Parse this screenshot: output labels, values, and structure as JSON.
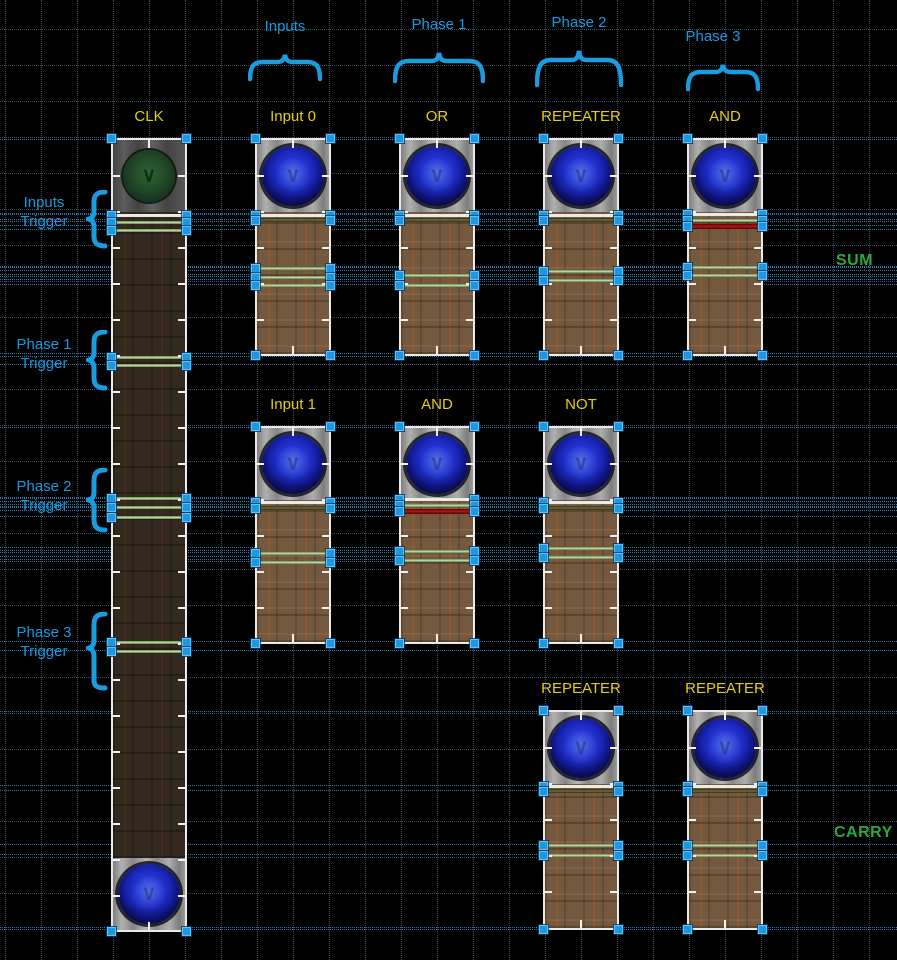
{
  "canvas": {
    "width": 897,
    "height": 960,
    "background": "#000000"
  },
  "grid": {
    "size": 36,
    "offset_x": 5,
    "offset_y": 29,
    "color": "#3b4d61",
    "guide_color": "#2e79ab"
  },
  "colors": {
    "annotation_blue": "#189ae2",
    "device_label_yellow": "#e5d005",
    "output_label_green": "#27a93f",
    "selection_handle_blue": "#1b98e0",
    "trigger_line_green": "#b2d395",
    "trigger_line_red": "#b41212",
    "trigger_line_white": "#eaeaea"
  },
  "top_groups": [
    {
      "label": "Inputs"
    },
    {
      "label": "Phase 1"
    },
    {
      "label": "Phase 2"
    },
    {
      "label": "Phase 3"
    }
  ],
  "left_triggers": [
    {
      "line1": "Inputs",
      "line2": "Trigger"
    },
    {
      "line1": "Phase 1",
      "line2": "Trigger"
    },
    {
      "line1": "Phase 2",
      "line2": "Trigger"
    },
    {
      "line1": "Phase 3",
      "line2": "Trigger"
    }
  ],
  "right_labels": [
    {
      "label": "SUM"
    },
    {
      "label": "CARRY"
    }
  ],
  "devices": [
    {
      "id": "clk-column",
      "label": "CLK",
      "x": 113,
      "y": 140,
      "w": 72,
      "h": 790,
      "top_button": "green",
      "bottom_button": "blue",
      "wood": "dark",
      "groups": [
        {
          "lines": [
            {
              "y": 215,
              "color": "white",
              "h": 3
            },
            {
              "y": 222,
              "color": "green",
              "h": 3
            },
            {
              "y": 230,
              "color": "green",
              "h": 3
            }
          ]
        },
        {
          "lines": [
            {
              "y": 357,
              "color": "green",
              "h": 3
            },
            {
              "y": 365,
              "color": "green",
              "h": 3
            }
          ]
        },
        {
          "lines": [
            {
              "y": 498,
              "color": "green",
              "h": 3
            },
            {
              "y": 507,
              "color": "green",
              "h": 3
            },
            {
              "y": 517,
              "color": "green",
              "h": 3
            }
          ]
        },
        {
          "lines": [
            {
              "y": 642,
              "color": "green",
              "h": 3
            },
            {
              "y": 651,
              "color": "green",
              "h": 3
            }
          ]
        }
      ]
    },
    {
      "id": "input0-column",
      "label": "Input 0",
      "x": 257,
      "y": 140,
      "w": 72,
      "h": 214,
      "top_button": "blue",
      "wood": "light",
      "groups": [
        {
          "lines": [
            {
              "y": 215,
              "color": "white",
              "h": 3
            },
            {
              "y": 220,
              "color": "olive",
              "h": 4
            }
          ]
        },
        {
          "lines": [
            {
              "y": 268,
              "color": "green",
              "h": 3
            },
            {
              "y": 277,
              "color": "green",
              "h": 3
            },
            {
              "y": 285,
              "color": "green",
              "h": 3
            }
          ]
        }
      ]
    },
    {
      "id": "or-column",
      "label": "OR",
      "x": 401,
      "y": 140,
      "w": 72,
      "h": 214,
      "top_button": "blue",
      "wood": "light",
      "groups": [
        {
          "lines": [
            {
              "y": 215,
              "color": "white",
              "h": 3
            },
            {
              "y": 220,
              "color": "olive",
              "h": 4
            }
          ]
        },
        {
          "lines": [
            {
              "y": 275,
              "color": "green",
              "h": 3
            },
            {
              "y": 285,
              "color": "green",
              "h": 3
            }
          ]
        }
      ]
    },
    {
      "id": "repeater-phase2-column",
      "label": "REPEATER",
      "x": 545,
      "y": 140,
      "w": 72,
      "h": 214,
      "top_button": "blue",
      "wood": "light",
      "groups": [
        {
          "lines": [
            {
              "y": 215,
              "color": "white",
              "h": 3
            },
            {
              "y": 220,
              "color": "olive",
              "h": 4
            }
          ]
        },
        {
          "lines": [
            {
              "y": 271,
              "color": "green",
              "h": 3
            },
            {
              "y": 280,
              "color": "green",
              "h": 3
            }
          ]
        }
      ]
    },
    {
      "id": "and-phase3-column",
      "label": "AND",
      "x": 689,
      "y": 140,
      "w": 72,
      "h": 214,
      "top_button": "blue",
      "wood": "light",
      "groups": [
        {
          "lines": [
            {
              "y": 214,
              "color": "white",
              "h": 3
            },
            {
              "y": 220,
              "color": "green",
              "h": 3
            },
            {
              "y": 226,
              "color": "red",
              "h": 5
            }
          ]
        },
        {
          "lines": [
            {
              "y": 267,
              "color": "green",
              "h": 3
            },
            {
              "y": 275,
              "color": "green",
              "h": 3
            }
          ]
        }
      ]
    },
    {
      "id": "input1-column",
      "label": "Input 1",
      "x": 257,
      "y": 428,
      "w": 72,
      "h": 214,
      "top_button": "blue",
      "wood": "light",
      "groups": [
        {
          "lines": [
            {
              "y": 502,
              "color": "white",
              "h": 3
            },
            {
              "y": 508,
              "color": "olive",
              "h": 4
            }
          ]
        },
        {
          "lines": [
            {
              "y": 553,
              "color": "green",
              "h": 3
            },
            {
              "y": 562,
              "color": "green",
              "h": 3
            }
          ]
        }
      ]
    },
    {
      "id": "and-phase1-column",
      "label": "AND",
      "x": 401,
      "y": 428,
      "w": 72,
      "h": 214,
      "top_button": "blue",
      "wood": "light",
      "groups": [
        {
          "lines": [
            {
              "y": 499,
              "color": "white",
              "h": 3
            },
            {
              "y": 505,
              "color": "green",
              "h": 3
            },
            {
              "y": 511,
              "color": "red",
              "h": 5
            }
          ]
        },
        {
          "lines": [
            {
              "y": 551,
              "color": "green",
              "h": 3
            },
            {
              "y": 560,
              "color": "green",
              "h": 3
            }
          ]
        }
      ]
    },
    {
      "id": "not-column",
      "label": "NOT",
      "x": 545,
      "y": 428,
      "w": 72,
      "h": 214,
      "top_button": "blue",
      "wood": "light",
      "groups": [
        {
          "lines": [
            {
              "y": 502,
              "color": "white",
              "h": 3
            },
            {
              "y": 508,
              "color": "olive",
              "h": 4
            }
          ]
        },
        {
          "lines": [
            {
              "y": 548,
              "color": "green",
              "h": 3
            },
            {
              "y": 557,
              "color": "green",
              "h": 3
            }
          ]
        }
      ]
    },
    {
      "id": "repeater-carry1-column",
      "label": "REPEATER",
      "x": 545,
      "y": 712,
      "w": 72,
      "h": 216,
      "top_button": "blue",
      "wood": "light",
      "groups": [
        {
          "lines": [
            {
              "y": 786,
              "color": "white",
              "h": 3
            },
            {
              "y": 791,
              "color": "olive",
              "h": 4
            }
          ]
        },
        {
          "lines": [
            {
              "y": 845,
              "color": "green",
              "h": 3
            },
            {
              "y": 855,
              "color": "green",
              "h": 3
            }
          ]
        }
      ]
    },
    {
      "id": "repeater-carry2-column",
      "label": "REPEATER",
      "x": 689,
      "y": 712,
      "w": 72,
      "h": 216,
      "top_button": "blue",
      "wood": "light",
      "groups": [
        {
          "lines": [
            {
              "y": 786,
              "color": "white",
              "h": 3
            },
            {
              "y": 791,
              "color": "olive",
              "h": 4
            }
          ]
        },
        {
          "lines": [
            {
              "y": 845,
              "color": "green",
              "h": 3
            },
            {
              "y": 855,
              "color": "green",
              "h": 3
            }
          ]
        }
      ]
    }
  ]
}
